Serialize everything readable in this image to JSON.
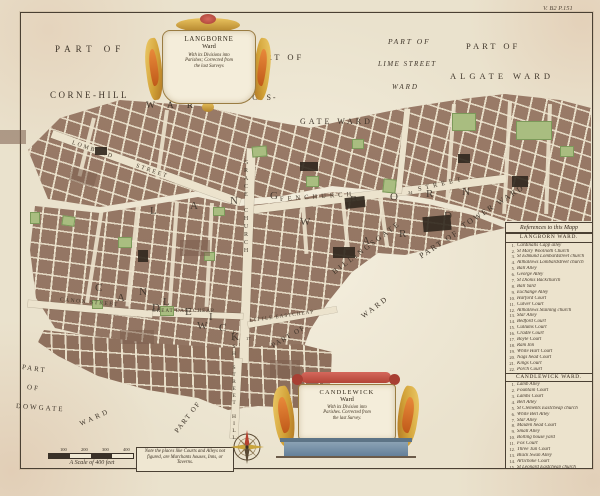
{
  "plate_number": "V. B2 P.151",
  "cartouches": {
    "top": {
      "title": "LANGBORNE",
      "ward": "Ward",
      "lines": [
        "With its Divisions into",
        "Parishes; Corrected from",
        "the last Surveys"
      ]
    },
    "bottom": {
      "title": "CANDLEWICK",
      "ward": "Ward",
      "lines": [
        "With its Division into",
        "Parishes. Corrected from",
        "the last Survey."
      ]
    }
  },
  "area_labels": {
    "part_of_nw": "PART OF",
    "cornhill": "CORNE-HILL",
    "cornhill_ward": "WARD",
    "part_of_bishops": "PART OF",
    "bishops_line1": "BISHOPS-",
    "bishops_line2": "GATE WARD",
    "part_of_lime": "PART OF",
    "lime_line1": "LIME STREET",
    "lime_line2": "WARD",
    "part_of_algate": "PART OF",
    "algate": "ALGATE WARD",
    "billingsgate_line1": "BILLINGSGATE",
    "billingsgate_line2": "WARD",
    "part_of_tower": "PART OF",
    "tower": "TOWER WARD",
    "dowgate_line1": "PART",
    "dowgate_line2": "OF",
    "dowgate_line3": "DOWGATE",
    "dowgate_line4": "WARD",
    "part_of_sw": "PART OF",
    "part_of_se": "PART OF"
  },
  "street_labels": {
    "fenchurch": "FENCHURCH",
    "fenchurch_street": "STREET",
    "lombard": "LOMBARD",
    "lombard_street": "STREET",
    "gracechurch": "GRACE CHURCH",
    "fish_hill": "FISH STREET HILL",
    "great_eastcheap": "GREAT EASTCHEAP",
    "little_eastcheap": "LITTLE EASTCHEAP",
    "canon": "CANON STREET"
  },
  "scatter": {
    "langborn": [
      "L",
      "A",
      "N",
      "G",
      "B",
      "O",
      "R",
      "N"
    ],
    "ward": [
      "W",
      "A",
      "R",
      "D"
    ],
    "candlewick": [
      "C",
      "A",
      "N",
      "D",
      "L",
      "E",
      "W",
      "I",
      "C",
      "K"
    ]
  },
  "map_numbers": [
    "34",
    "17"
  ],
  "references": {
    "title": "References to this Mapp",
    "sections": [
      {
        "heading": "LANGBORN WARD.",
        "items": [
          [
            "1",
            "Cardinalls Capp alley"
          ],
          [
            "2",
            "St Mary Woolnoth Church"
          ],
          [
            "3",
            "St Edmund Lombardstreet church"
          ],
          [
            "4",
            "Allhallows Lombardstreet church"
          ],
          [
            "5",
            "Ball Alley"
          ],
          [
            "6",
            "George Alley"
          ],
          [
            "7",
            "St Dionis Backchurch"
          ],
          [
            "8",
            "Ball Yard"
          ],
          [
            "9",
            "Exchange Alley"
          ],
          [
            "10",
            "Harford Court"
          ],
          [
            "11",
            "Culver Court"
          ],
          [
            "12",
            "Allhallows Staining church"
          ],
          [
            "13",
            "Star Alley"
          ],
          [
            "14",
            "Bedford Court"
          ],
          [
            "15",
            "Cullums Court"
          ],
          [
            "16",
            "Cradle Court"
          ],
          [
            "17",
            "Boyle Court"
          ],
          [
            "18",
            "Ram Inn"
          ],
          [
            "19",
            "White Hart Court"
          ],
          [
            "20",
            "Nags head Court"
          ],
          [
            "21",
            "Kings Court"
          ],
          [
            "22",
            "Porch Court"
          ]
        ]
      },
      {
        "heading": "CANDLEWICK WARD.",
        "items": [
          [
            "1",
            "Lamb Alley"
          ],
          [
            "2",
            "Fountain Court"
          ],
          [
            "3",
            "Lambs Court"
          ],
          [
            "4",
            "Bell Alley"
          ],
          [
            "5",
            "St Clements Eastcheap church"
          ],
          [
            "6",
            "White Bell Alley"
          ],
          [
            "7",
            "Star Alley"
          ],
          [
            "8",
            "Maiden head Court"
          ],
          [
            "9",
            "Small Alley"
          ],
          [
            "10",
            "Bolting house yard"
          ],
          [
            "11",
            "Fox Court"
          ],
          [
            "12",
            "Three Tun Court"
          ],
          [
            "13",
            "Black Swan Alley"
          ],
          [
            "14",
            "Artichoke Court"
          ],
          [
            "15",
            "St Leonard Eastcheap church"
          ]
        ]
      }
    ]
  },
  "scale": {
    "ticks": [
      "100",
      "200",
      "300",
      "400"
    ],
    "label": "A Scale of 400 feet"
  },
  "note": "Note the places like Courts and Alleys not figured, are Marchants houses, Inns, or Taverns.",
  "colors": {
    "block_brown": "#9a7b68",
    "garden_green": "#a9bd80",
    "dark_building": "#32291f",
    "cartouche_gold": "#d2a43c",
    "ribbon_red": "#c05244",
    "pedestal_blue": "#7d93a4",
    "paper": "#eae2cd"
  }
}
